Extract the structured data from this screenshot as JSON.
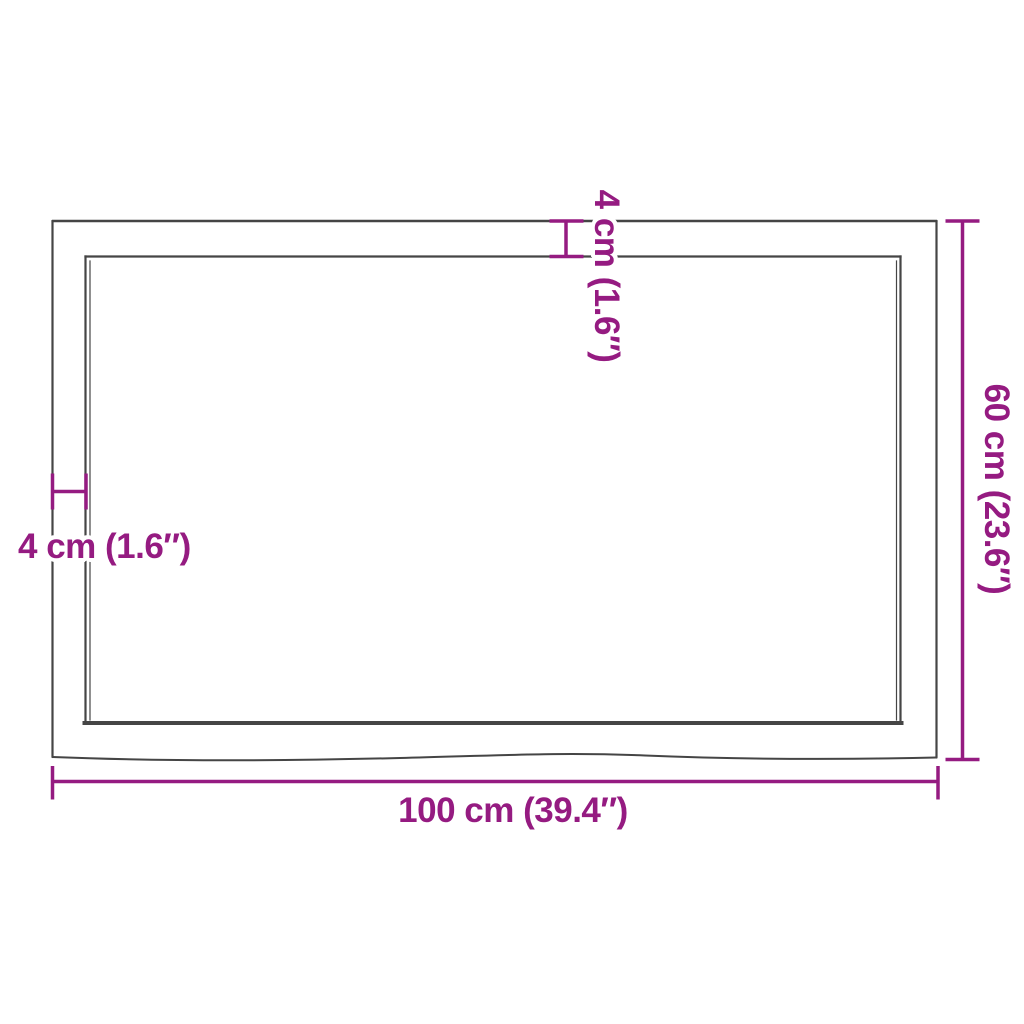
{
  "diagram": {
    "width_label": "100 cm (39.4″)",
    "height_label": "60 cm (23.6″)",
    "thickness_left_label": "4 cm (1.6″)",
    "thickness_top_label": "4 cm (1.6″)",
    "colors": {
      "dimension": "#951B81",
      "outline": "#454545",
      "background": "#FFFFFF"
    }
  }
}
